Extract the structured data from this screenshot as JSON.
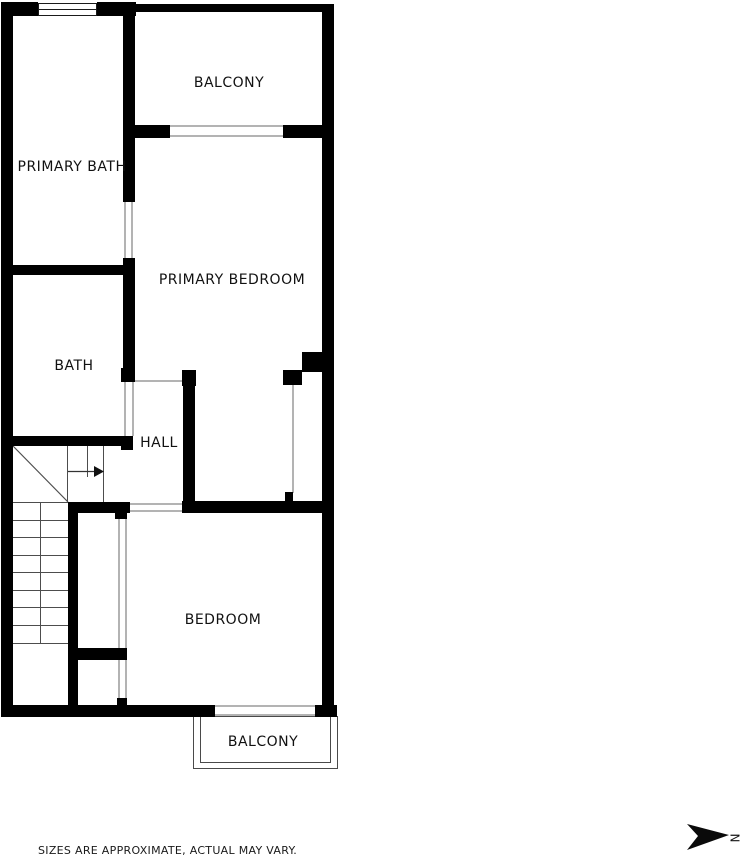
{
  "floor_plan": {
    "rooms": [
      {
        "id": "balcony-top",
        "label": "BALCONY"
      },
      {
        "id": "primary-bath",
        "label": "PRIMARY BATH"
      },
      {
        "id": "primary-bedroom",
        "label": "PRIMARY BEDROOM"
      },
      {
        "id": "bath",
        "label": "BATH"
      },
      {
        "id": "hall",
        "label": "HALL"
      },
      {
        "id": "bedroom",
        "label": "BEDROOM"
      },
      {
        "id": "balcony-bottom",
        "label": "BALCONY"
      }
    ],
    "disclaimer": "SIZES ARE APPROXIMATE, ACTUAL MAY VARY.",
    "compass": {
      "label": "N"
    },
    "colors": {
      "wall": "#000000",
      "background": "#ffffff",
      "opening_line": "#b3b3b3",
      "stair_line": "#4d4d4d"
    }
  }
}
